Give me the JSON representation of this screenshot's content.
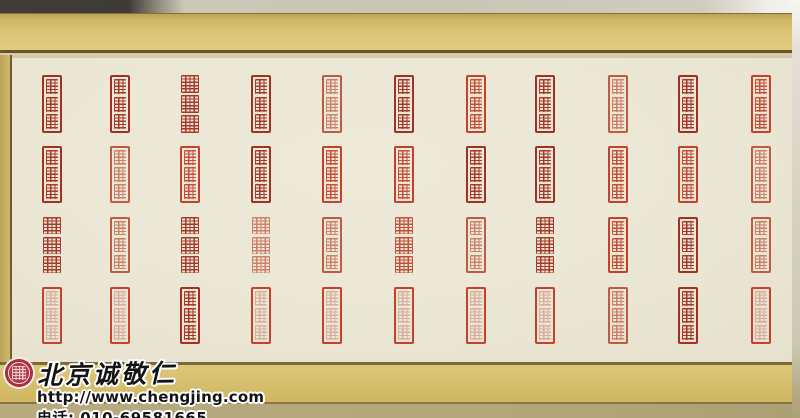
{
  "watermark": {
    "brand": "北京诚敬仁",
    "url": "http://www.chengjing.com",
    "phone": "电话: 010-69581665",
    "logo": "circular-red-seal-logo"
  },
  "colors": {
    "paper": "#ebe7d5",
    "gold_band": "#d7c172",
    "trim_line": "#6b5424",
    "bottom_strip": "#b3a67c",
    "seal_dark": "#a43022",
    "seal_bright": "#c7402c",
    "seal_light": "#c05a42",
    "seal_faint_glyph": "#d5a093",
    "watermark_text": "#141414",
    "watermark_outline": "#ffffff",
    "logo_red": "#ad2f44"
  },
  "scroll": {
    "description": "horizontal scroll of red seal-script stamp impressions on cream paper, 11 columns x 4 rows",
    "columns_x": [
      52,
      120,
      190,
      261,
      332,
      404,
      476,
      545,
      618,
      688,
      761
    ],
    "rows_y": [
      75,
      146,
      217,
      287
    ],
    "row_heights": [
      58,
      57,
      56,
      57
    ],
    "seal_width": 20,
    "seals": [
      {
        "c": 0,
        "r": 0,
        "style": "framed",
        "tone": "dark"
      },
      {
        "c": 1,
        "r": 0,
        "style": "framed",
        "tone": "dark"
      },
      {
        "c": 2,
        "r": 0,
        "style": "relief",
        "tone": "dark"
      },
      {
        "c": 3,
        "r": 0,
        "style": "framed",
        "tone": "dark"
      },
      {
        "c": 4,
        "r": 0,
        "style": "framed",
        "tone": "light"
      },
      {
        "c": 5,
        "r": 0,
        "style": "framed",
        "tone": "dark"
      },
      {
        "c": 6,
        "r": 0,
        "style": "framed",
        "tone": "bright"
      },
      {
        "c": 7,
        "r": 0,
        "style": "framed",
        "tone": "dark"
      },
      {
        "c": 8,
        "r": 0,
        "style": "framed",
        "tone": "light"
      },
      {
        "c": 9,
        "r": 0,
        "style": "framed",
        "tone": "dark"
      },
      {
        "c": 10,
        "r": 0,
        "style": "framed",
        "tone": "bright"
      },
      {
        "c": 0,
        "r": 1,
        "style": "framed",
        "tone": "dark"
      },
      {
        "c": 1,
        "r": 1,
        "style": "framed",
        "tone": "light"
      },
      {
        "c": 2,
        "r": 1,
        "style": "framed",
        "tone": "bright"
      },
      {
        "c": 3,
        "r": 1,
        "style": "framed",
        "tone": "dark"
      },
      {
        "c": 4,
        "r": 1,
        "style": "framed",
        "tone": "bright"
      },
      {
        "c": 5,
        "r": 1,
        "style": "framed",
        "tone": "bright"
      },
      {
        "c": 6,
        "r": 1,
        "style": "framed",
        "tone": "dark"
      },
      {
        "c": 7,
        "r": 1,
        "style": "framed",
        "tone": "dark"
      },
      {
        "c": 8,
        "r": 1,
        "style": "framed",
        "tone": "bright"
      },
      {
        "c": 9,
        "r": 1,
        "style": "framed",
        "tone": "bright"
      },
      {
        "c": 10,
        "r": 1,
        "style": "framed",
        "tone": "light"
      },
      {
        "c": 0,
        "r": 2,
        "style": "relief",
        "tone": "dark"
      },
      {
        "c": 1,
        "r": 2,
        "style": "framed",
        "tone": "light"
      },
      {
        "c": 2,
        "r": 2,
        "style": "relief",
        "tone": "dark"
      },
      {
        "c": 3,
        "r": 2,
        "style": "relief",
        "tone": "light"
      },
      {
        "c": 4,
        "r": 2,
        "style": "framed",
        "tone": "light"
      },
      {
        "c": 5,
        "r": 2,
        "style": "relief",
        "tone": "bright"
      },
      {
        "c": 6,
        "r": 2,
        "style": "framed",
        "tone": "light"
      },
      {
        "c": 7,
        "r": 2,
        "style": "relief",
        "tone": "dark"
      },
      {
        "c": 8,
        "r": 2,
        "style": "framed",
        "tone": "bright"
      },
      {
        "c": 9,
        "r": 2,
        "style": "framed",
        "tone": "dark"
      },
      {
        "c": 10,
        "r": 2,
        "style": "framed",
        "tone": "light"
      },
      {
        "c": 0,
        "r": 3,
        "style": "framed",
        "tone": "faint"
      },
      {
        "c": 1,
        "r": 3,
        "style": "framed",
        "tone": "faint"
      },
      {
        "c": 2,
        "r": 3,
        "style": "framed",
        "tone": "dark"
      },
      {
        "c": 3,
        "r": 3,
        "style": "framed",
        "tone": "faint"
      },
      {
        "c": 4,
        "r": 3,
        "style": "framed",
        "tone": "faint"
      },
      {
        "c": 5,
        "r": 3,
        "style": "framed",
        "tone": "faint"
      },
      {
        "c": 6,
        "r": 3,
        "style": "framed",
        "tone": "faint"
      },
      {
        "c": 7,
        "r": 3,
        "style": "framed",
        "tone": "faint"
      },
      {
        "c": 8,
        "r": 3,
        "style": "framed",
        "tone": "light"
      },
      {
        "c": 9,
        "r": 3,
        "style": "framed",
        "tone": "dark"
      },
      {
        "c": 10,
        "r": 3,
        "style": "framed",
        "tone": "faint"
      }
    ]
  }
}
